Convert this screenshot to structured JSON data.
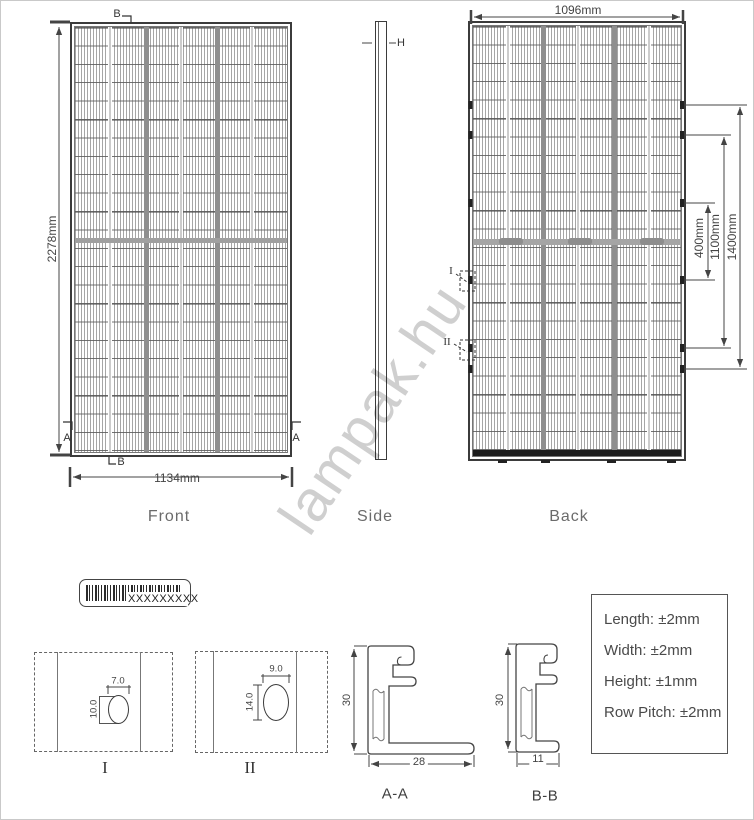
{
  "watermark": "lampak.hu",
  "views": {
    "front": {
      "label": "Front",
      "height_dim": "2278mm",
      "width_dim": "1134mm",
      "section_marker_b_top": "B",
      "section_marker_b_bottom": "B",
      "section_marker_a_left": "A",
      "section_marker_a_right": "A"
    },
    "side": {
      "label": "Side",
      "thickness_marker": "H"
    },
    "back": {
      "label": "Back",
      "width_dim": "1096mm",
      "mount_dims": [
        "400mm",
        "1100mm",
        "1400mm"
      ],
      "detail_marker_i": "I",
      "detail_marker_ii": "II"
    }
  },
  "bottom": {
    "barcode_label": "XXXXXXXXX",
    "detail_i": {
      "label": "I",
      "width_dim": "7.0",
      "height_dim": "10.0"
    },
    "detail_ii": {
      "label": "II",
      "width_dim": "9.0",
      "height_dim": "14.0"
    },
    "section_aa": {
      "label": "A-A",
      "height_dim": "30",
      "width_dim": "28"
    },
    "section_bb": {
      "label": "B-B",
      "height_dim": "30",
      "width_dim": "11"
    },
    "tolerances": {
      "length": "Length: ±2mm",
      "width": "Width: ±2mm",
      "height": "Height: ±1mm",
      "row_pitch": "Row Pitch: ±2mm"
    }
  }
}
